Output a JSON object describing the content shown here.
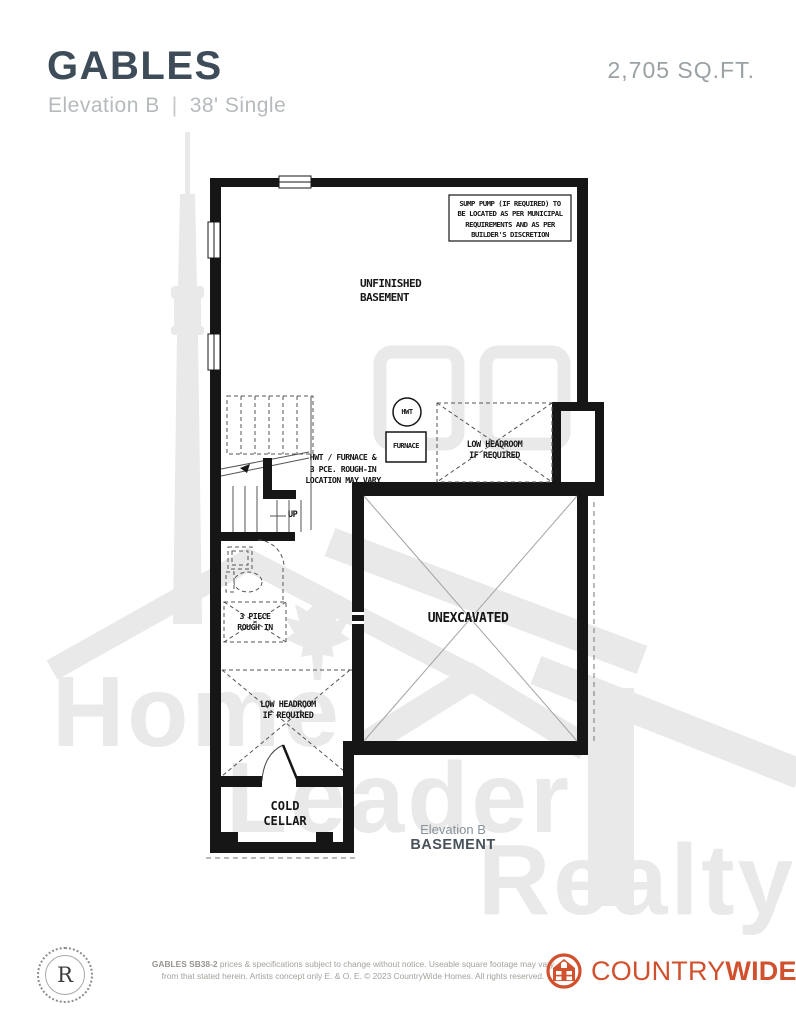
{
  "header": {
    "title": "GABLES",
    "subtitle_elevation": "Elevation B",
    "subtitle_divider": "|",
    "subtitle_model": "38' Single",
    "sqft": "2,705 SQ.FT."
  },
  "plan": {
    "sump_note": [
      "SUMP PUMP (IF REQUIRED) TO",
      "BE LOCATED AS PER MUNICIPAL",
      "REQUIREMENTS AND AS PER",
      "BUILDER'S DISCRETION"
    ],
    "unfinished_basement": [
      "UNFINISHED",
      "BASEMENT"
    ],
    "hwt": "HWT",
    "furnace": "FURNACE",
    "low_headroom_right": [
      "LOW HEADROOM",
      "IF REQUIRED"
    ],
    "hwt_note": [
      "HWT / FURNACE &",
      "3 PCE. ROUGH-IN",
      "LOCATION MAY VARY"
    ],
    "up": "UP",
    "rough_in": [
      "3 PIECE",
      "ROUGH IN"
    ],
    "unexcavated": "UNEXCAVATED",
    "low_headroom_bottom": [
      "LOW HEADROOM",
      "IF REQUIRED"
    ],
    "cold_cellar": [
      "COLD",
      "CELLAR"
    ],
    "caption_elevation": "Elevation B",
    "caption_level": "BASEMENT"
  },
  "watermark": {
    "words": [
      "Home",
      "Leader",
      "Realty"
    ]
  },
  "footer": {
    "seal_letter": "R",
    "disclaimer_bold": "GABLES SB38-2",
    "disclaimer_line1_rest": " prices & specifications subject to change without notice. Useable square footage may vary",
    "disclaimer_line2": "from that stated herein. Artists concept only E. & O. E. © 2023 CountryWide Homes. All rights reserved.",
    "brand_country": "COUNTRY",
    "brand_wide": "WIDE"
  },
  "colors": {
    "title": "#3d4c58",
    "subtitle": "#b5babd",
    "sqft": "#9aa1a5",
    "brand": "#d1502e",
    "watermark": "#e9e9e9",
    "plan_line": "#161616"
  }
}
